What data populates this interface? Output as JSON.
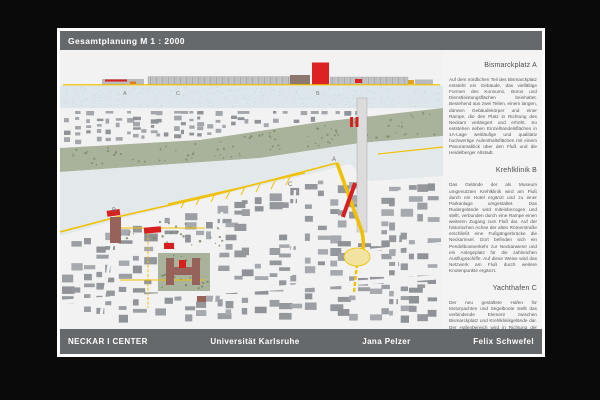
{
  "board": {
    "title": "Gesamtplanung M 1 : 2000"
  },
  "map": {
    "elevation_labels": {
      "a": "A",
      "c": "C",
      "b": "B"
    },
    "plan_labels": {
      "a": "A",
      "b": "B",
      "c": "C"
    },
    "colors": {
      "accent_red": "#dd2222",
      "path_yellow": "#f0c000",
      "park_green": "#a9b29a",
      "building_gray": "#9b9ea3",
      "museum_brown": "#96625a",
      "water": "#e3e8eb",
      "bar_gray": "#66696c"
    }
  },
  "sections": [
    {
      "heading": "Bismarckplatz A",
      "body": "Auf dem nördlichen Teil des Bismarckplatz entsteht ein Gebäude, das vielfältige Formen des Konsums, Büros und Dienstleistungsflächen beinhaltet. Bestehend aus zwei Teilen, einem langen, dünnen Gebäudekörper und einer Rampe, die den Platz in Richtung des Neckars verlängert und erhöht. So entstehen neben Einzelhandelsflächen in 1A-Lage weitläufige und qualitativ hochwertige Aufenthaltsflächen mit einem Panoramablick über den Fluß und die Heidelberger Altstadt."
    },
    {
      "heading": "Krehlklinik B",
      "body": "Das Gelände der als Museum umgenutzten Krehlklinik wird am Fluß durch ein Hotel ergänzt und zu einer Parkanlage umgestaltet. Das Rudergelände wird miteinbezogen und stellt, verbunden durch eine Rampe einen weiteren Zugang zum Fluß dar. Auf der historischen Achse der alten Römerstraße erschließt eine Fußgängerbrücke die Neckarinsel. Dort befinden sich ein Pendelbootverkehr zur Neckarwiese und ein Anlegeplatz für die zahlreichen Ausflugsschiffe. Auf diese Weise wird das Netzwerk am Fluß durch weitere Knotenpunkte ergänzt."
    },
    {
      "heading": "Yachthafen C",
      "body": "Der neu gestaltete Hafen für Motoryachten und Segelboote stellt das verbindende Element zwischen Bismarckplatz und Krehlklinikgelände dar. Der Hafenbereich wird in Richtung der Insel durch den Anlegepier begrenzt und mit einer Uferpromenade nach Westen bis zum Ruderhaus und nach Osten bis zur Stadthalle erweitert. Zwischen den Anlegestellen bieten „schwimmende“ Flächen auf dem Wasser Raum zum Verweilen."
    }
  ],
  "footer": {
    "project": "NECKAR I CENTER",
    "university": "Universität Karlsruhe",
    "author1": "Jana Pelzer",
    "author2": "Felix Schwefel"
  }
}
